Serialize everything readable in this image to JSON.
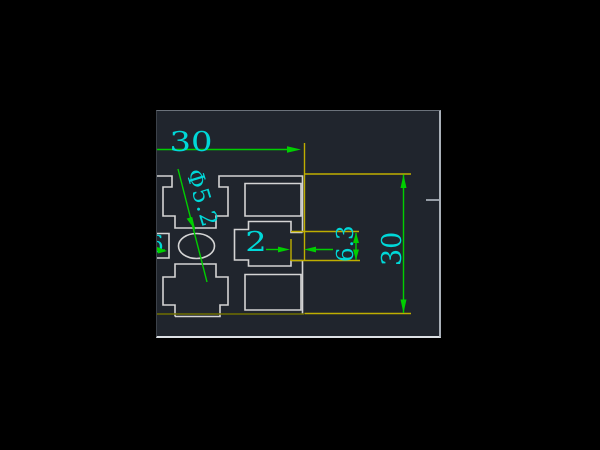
{
  "viewport": {
    "page_background": "#000000",
    "canvas_background": "#20252d"
  },
  "palette": {
    "profile_line": "#d4d4d4",
    "dimension_line": "#00cf00",
    "extension_line": "#bfae00",
    "extension_line_dark": "#6f6f00",
    "dimension_text": "#00d8d8",
    "border_tick": "#969da6"
  },
  "dimensions": {
    "width_top": "30",
    "hole_dia": "Φ5.2",
    "lip": "2",
    "slot_opening": "6.3",
    "height_right": "30",
    "clipped_left_fragment": "6"
  }
}
